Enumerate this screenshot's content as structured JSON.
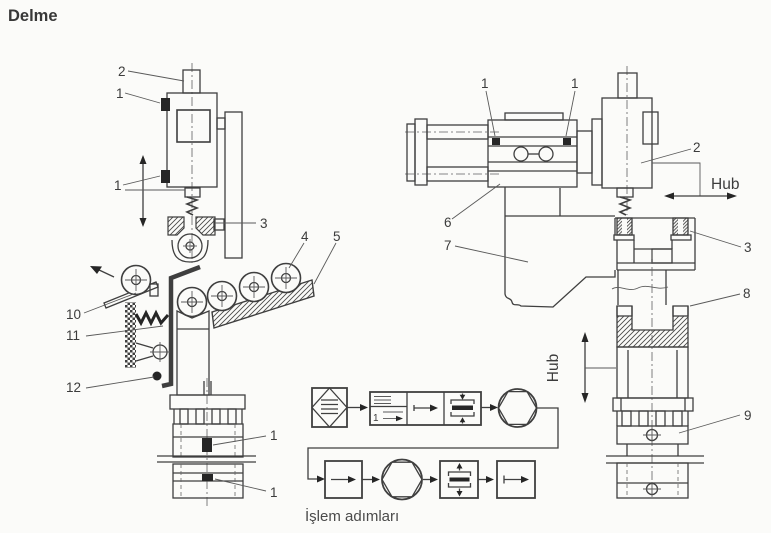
{
  "title": "Delme",
  "colors": {
    "line": "#3f3f3f",
    "ink": "#262626",
    "background": "#fbfbf9",
    "text": "#3c3c3c"
  },
  "left_station": {
    "labels": {
      "spindle": "2",
      "sensor_upper": "1",
      "sensor_lower": "1",
      "drill_bush": "3",
      "workpiece_roll": "4",
      "ramp": "5",
      "chute": "10",
      "lever_spring": "11",
      "stop": "12",
      "cyl_sensor_upper": "1",
      "cyl_sensor_lower": "1"
    }
  },
  "right_station": {
    "labels": {
      "sensor_left": "1",
      "sensor_right": "1",
      "drill_head": "2",
      "bushing_plate": "3",
      "slide": "6",
      "frame": "7",
      "workpiece": "8",
      "cylinder": "9"
    },
    "hub_horizontal": "Hub",
    "hub_vertical": "Hub"
  },
  "flowchart": {
    "caption": "İşlem adımları",
    "step_number": "1"
  }
}
